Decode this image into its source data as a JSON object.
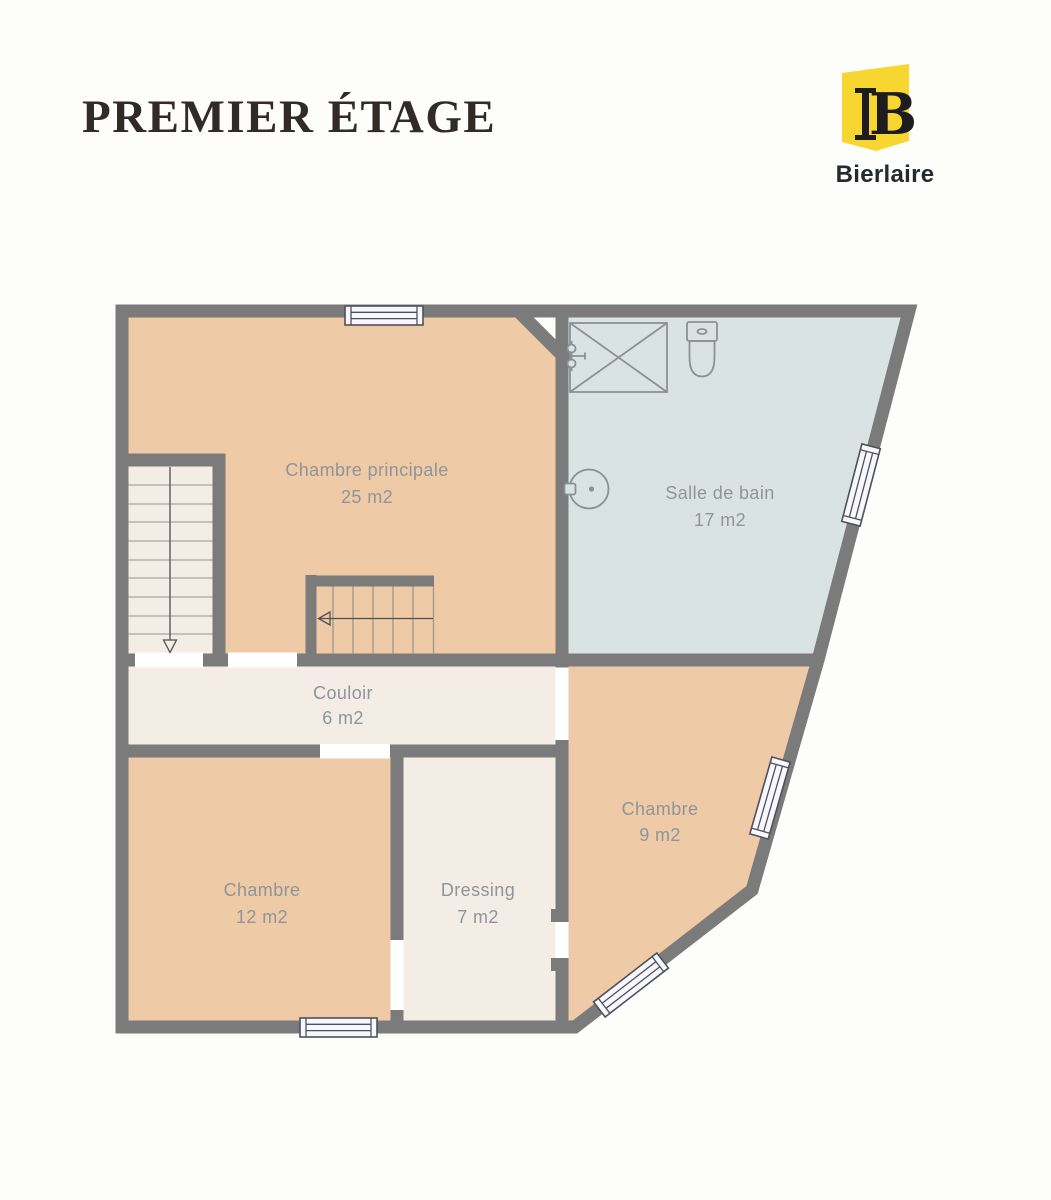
{
  "header": {
    "title": "PREMIER ÉTAGE"
  },
  "logo": {
    "brand": "Bierlaire",
    "monogram": "B"
  },
  "colors": {
    "page_bg": "#fdfdfb",
    "wall": "#7b7b7b",
    "bedroom_floor": "#eecaa7",
    "bathroom_floor": "#d9e4e2",
    "hallway_floor": "#f3ede6",
    "window_fill": "#f7f8fd",
    "window_stroke": "#50505c",
    "fixture_stroke": "#8a9193",
    "label_text": "#8f959b",
    "title_text": "#312b28",
    "accent_yellow": "#f7d631",
    "logo_ink": "#1d1d1f",
    "brand_text": "#26292e"
  },
  "rooms": [
    {
      "name": "Chambre principale",
      "area": "25 m2"
    },
    {
      "name": "Salle de bain",
      "area": "17 m2"
    },
    {
      "name": "Couloir",
      "area": "6 m2"
    },
    {
      "name": "Chambre",
      "area": "9 m2"
    },
    {
      "name": "Chambre",
      "area": "12 m2"
    },
    {
      "name": "Dressing",
      "area": "7 m2"
    }
  ]
}
